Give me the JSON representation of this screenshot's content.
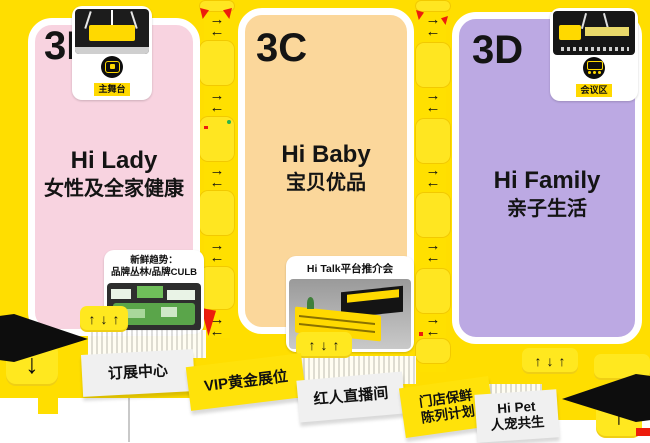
{
  "colors": {
    "background_yellow": "#FFDE00",
    "corridor_yellow": "#FFE621",
    "zone_pink": "#F8D3E0",
    "zone_orange": "#FBD79B",
    "zone_purple": "#BCA9E3",
    "accent_red": "#ED1C0C",
    "ribbon_grey": "#F0F0F0",
    "label_chip_yellow": "#FFD900",
    "ink_black": "#111111"
  },
  "glyphs": {
    "right": "→",
    "left": "←",
    "up": "↑",
    "down": "↓"
  },
  "zones": {
    "b": {
      "id": "3B",
      "title_en": "Hi Lady",
      "title_cn": "女性及全家健康",
      "top_card": {
        "label": "主舞台",
        "icon": "thumbs-up-stage-icon"
      },
      "bottom_card": {
        "line1": "新鲜趋势：",
        "line2": "品牌丛林/品牌CULB"
      }
    },
    "c": {
      "id": "3C",
      "title_en": "Hi Baby",
      "title_cn": "宝贝优品",
      "bottom_card": {
        "label": "Hi Talk平台推介会"
      }
    },
    "d": {
      "id": "3D",
      "title_en": "Hi Family",
      "title_cn": "亲子生活",
      "top_card": {
        "label": "会议区",
        "icon": "meeting-screen-icon"
      }
    }
  },
  "ribbons": {
    "booking": {
      "label": "订展中心"
    },
    "vip": {
      "label": "VIP黄金展位"
    },
    "live": {
      "label": "红人直播间"
    },
    "store": {
      "line1": "门店保鲜",
      "line2": "陈列计划"
    },
    "pet": {
      "line1": "Hi Pet",
      "line2": "人宠共生"
    }
  }
}
